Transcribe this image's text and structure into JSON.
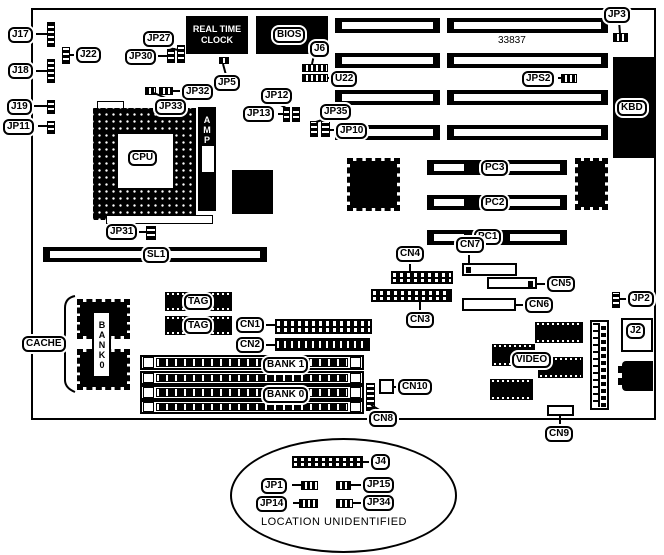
{
  "diagram": {
    "kind": "motherboard-layout",
    "part_number": "33837",
    "note": "LOCATION UNIDENTIFIED"
  },
  "rtc": {
    "line1": "REAL TIME",
    "line2": "CLOCK"
  },
  "labels": {
    "j17": "J17",
    "j18": "J18",
    "j19": "J19",
    "jp11": "JP11",
    "j22": "J22",
    "jp27": "JP27",
    "jp30": "JP30",
    "jp32": "JP32",
    "jp33": "JP33",
    "jp5": "JP5",
    "jp12": "JP12",
    "jp13": "JP13",
    "jp31": "JP31",
    "jp35": "JP35",
    "jp10": "JP10",
    "j6": "J6",
    "u22": "U22",
    "jp3": "JP3",
    "jps2": "JPS2",
    "bios": "BIOS",
    "kbd": "KBD",
    "cpu": "CPU",
    "amp": "AMP",
    "sl1": "SL1",
    "pc1": "PC1",
    "pc2": "PC2",
    "pc3": "PC3",
    "cn1": "CN1",
    "cn2": "CN2",
    "cn3": "CN3",
    "cn4": "CN4",
    "cn5": "CN5",
    "cn6": "CN6",
    "cn7": "CN7",
    "cn8": "CN8",
    "cn9": "CN9",
    "cn10": "CN10",
    "cache": "CACHE",
    "bank0_chip": "BANK0",
    "tag": "TAG",
    "bank1": "BANK 1",
    "bank0": "BANK 0",
    "video": "VIDEO",
    "j2": "J2",
    "jp2": "JP2",
    "j4": "J4",
    "jp1": "JP1",
    "jp15": "JP15",
    "jp14": "JP14",
    "jp34": "JP34"
  }
}
